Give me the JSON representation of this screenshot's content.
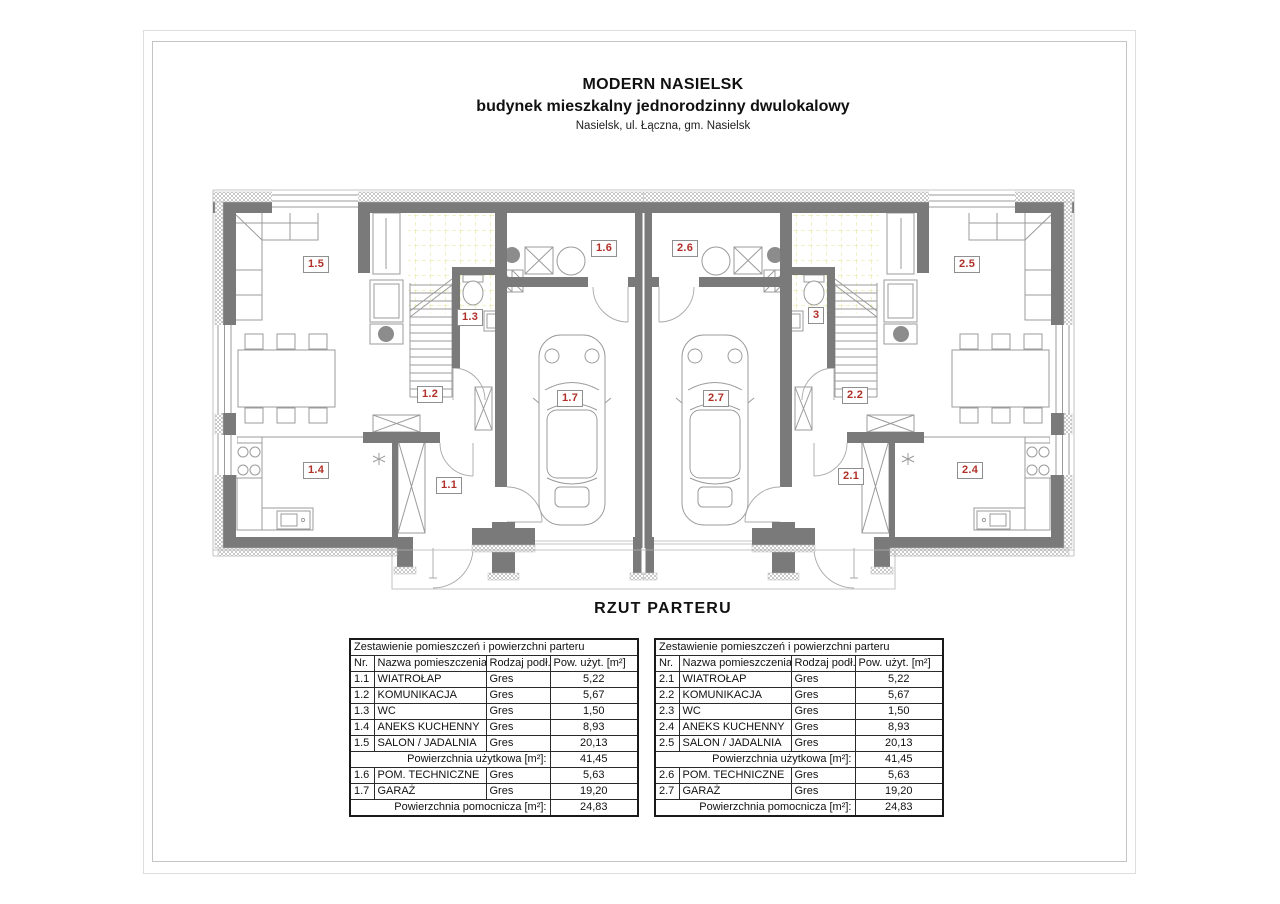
{
  "page": {
    "title_line1": "MODERN NASIELSK",
    "title_line2": "budynek mieszkalny jednorodzinny dwulokalowy",
    "title_line3": "Nasielsk, ul. Łączna, gm. Nasielsk",
    "caption": "RZUT PARTERU"
  },
  "colors": {
    "wall": "#7a7a7a",
    "hatch": "#c9c9c9",
    "line": "#9b9b9b",
    "thin": "#b3b3b3",
    "label_red": "#b03028",
    "grid_yellow": "#e3e394",
    "table_border": "#1a1a1a"
  },
  "plan": {
    "labels": {
      "r11": "1.1",
      "r12": "1.2",
      "r13": "1.3",
      "r14": "1.4",
      "r15": "1.5",
      "r16": "1.6",
      "r17": "1.7",
      "r21": "2.1",
      "r22": "2.2",
      "r23": "3",
      "r24": "2.4",
      "r25": "2.5",
      "r26": "2.6",
      "r27": "2.7"
    }
  },
  "tables": {
    "title": "Zestawienie pomieszczeń i powierzchni parteru",
    "headers": {
      "nr": "Nr.",
      "name": "Nazwa pomieszczenia",
      "floor": "Rodzaj podł.",
      "area": "Pow. użyt. [m²]"
    },
    "usable_label": "Powierzchnia użytkowa [m²]:",
    "aux_label": "Powierzchnia pomocnicza [m²]:",
    "left": {
      "rows": [
        {
          "nr": "1.1",
          "name": "WIATROŁAP",
          "floor": "Gres",
          "area": "5,22"
        },
        {
          "nr": "1.2",
          "name": "KOMUNIKACJA",
          "floor": "Gres",
          "area": "5,67"
        },
        {
          "nr": "1.3",
          "name": "WC",
          "floor": "Gres",
          "area": "1,50"
        },
        {
          "nr": "1.4",
          "name": "ANEKS KUCHENNY",
          "floor": "Gres",
          "area": "8,93"
        },
        {
          "nr": "1.5",
          "name": "SALON / JADALNIA",
          "floor": "Gres",
          "area": "20,13"
        }
      ],
      "usable_value": "41,45",
      "aux_rows": [
        {
          "nr": "1.6",
          "name": "POM. TECHNICZNE",
          "floor": "Gres",
          "area": "5,63"
        },
        {
          "nr": "1.7",
          "name": "GARAŻ",
          "floor": "Gres",
          "area": "19,20"
        }
      ],
      "aux_value": "24,83"
    },
    "right": {
      "rows": [
        {
          "nr": "2.1",
          "name": "WIATROŁAP",
          "floor": "Gres",
          "area": "5,22"
        },
        {
          "nr": "2.2",
          "name": "KOMUNIKACJA",
          "floor": "Gres",
          "area": "5,67"
        },
        {
          "nr": "2.3",
          "name": "WC",
          "floor": "Gres",
          "area": "1,50"
        },
        {
          "nr": "2.4",
          "name": "ANEKS KUCHENNY",
          "floor": "Gres",
          "area": "8,93"
        },
        {
          "nr": "2.5",
          "name": "SALON / JADALNIA",
          "floor": "Gres",
          "area": "20,13"
        }
      ],
      "usable_value": "41,45",
      "aux_rows": [
        {
          "nr": "2.6",
          "name": "POM. TECHNICZNE",
          "floor": "Gres",
          "area": "5,63"
        },
        {
          "nr": "2.7",
          "name": "GARAŻ",
          "floor": "Gres",
          "area": "19,20"
        }
      ],
      "aux_value": "24,83"
    }
  }
}
